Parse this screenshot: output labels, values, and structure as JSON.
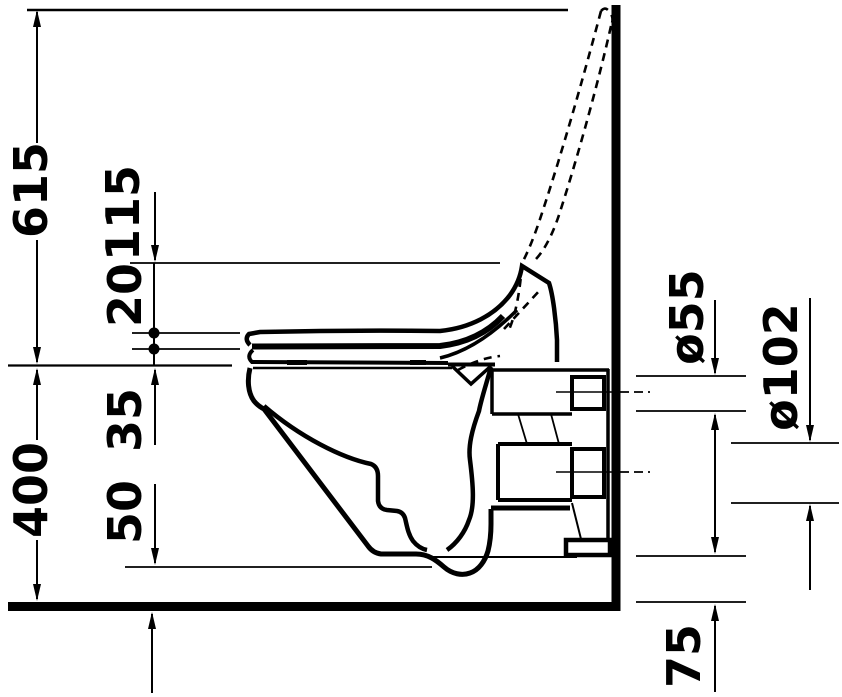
{
  "drawing": {
    "kind": "technical line drawing, side elevation of a wall-hung toilet with seat and raised lid shown dashed",
    "background_color": "#ffffff",
    "ink_color": "#000000",
    "labels": {
      "height_615": "615",
      "offset_115": "115",
      "gap_20": "20",
      "depth_35": "35",
      "height_400": "400",
      "clearance_50": "50",
      "dia_55": "ø55",
      "dia_102": "ø102",
      "height_75": "75"
    }
  }
}
